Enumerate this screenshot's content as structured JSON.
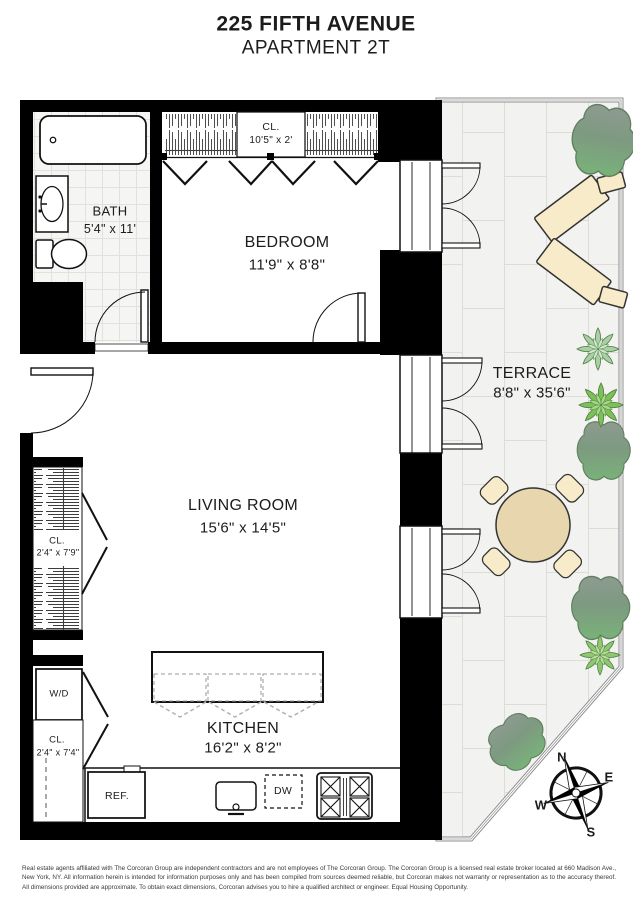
{
  "header": {
    "building": "225 FIFTH AVENUE",
    "unit": "APARTMENT 2T"
  },
  "rooms": {
    "bath": {
      "name": "BATH",
      "dims": "5'4\" x 11'"
    },
    "bedroom_closet": {
      "name": "CL.",
      "dims": "10'5\" x 2'"
    },
    "bedroom": {
      "name": "BEDROOM",
      "dims": "11'9\" x 8'8\""
    },
    "terrace": {
      "name": "TERRACE",
      "dims": "8'8\" x 35'6\""
    },
    "living_room": {
      "name": "LIVING ROOM",
      "dims": "15'6\" x 14'5\""
    },
    "hall_closet": {
      "name": "CL.",
      "dims": "2'4\" x 7'9\""
    },
    "laundry_closet": {
      "name": "CL.",
      "dims": "2'4\" x 7'4\""
    },
    "kitchen": {
      "name": "KITCHEN",
      "dims": "16'2\" x 8'2\""
    }
  },
  "appliances": {
    "washer_dryer": "W/D",
    "refrigerator": "REF.",
    "dishwasher": "DW"
  },
  "compass": {
    "north": "N",
    "east": "E",
    "south": "S",
    "west": "W"
  },
  "disclaimer": "Real estate agents affiliated with The Corcoran Group are independent contractors and are not employees of The Corcoran Group. The Corcoran Group is a licensed real estate broker located at 660 Madison Ave., New York, NY. All information herein is intended for information purposes only and has been compiled from sources deemed reliable, but Corcoran makes not warranty or representation as to the accuracy thereof. All dimensions provided are approximate. To obtain exact dimensions, Corcoran advises you to hire a qualified architect or engineer. Equal Housing Opportunity.",
  "colors": {
    "wall": "#000000",
    "terrace_tile": "#f2f2f0",
    "furniture_tan": "#f7ebca",
    "table_tan": "#e8d6af",
    "succulent_green": "#7dbf59",
    "bush_green": "#79b279"
  }
}
